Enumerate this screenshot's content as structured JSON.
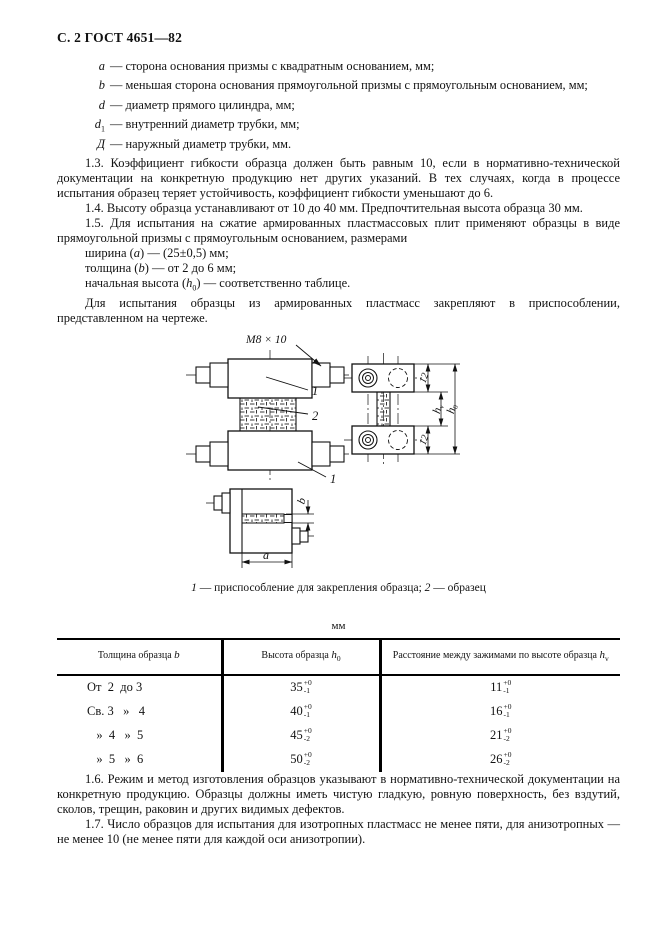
{
  "header": "С. 2 ГОСТ 4651—82",
  "definitions": [
    {
      "term": "a",
      "sub": "",
      "text": "— сторона основания призмы с квадратным основанием, мм;"
    },
    {
      "term": "b",
      "sub": "",
      "text": "— меньшая сторона основания прямоугольной призмы с прямоугольным основанием, мм;"
    },
    {
      "term": "d",
      "sub": "",
      "text": "— диаметр прямого цилиндра, мм;"
    },
    {
      "term": "d",
      "sub": "1",
      "text": "— внутренний диаметр трубки, мм;"
    },
    {
      "term": "Д",
      "sub": "",
      "text": "— наружный диаметр трубки, мм."
    }
  ],
  "para_1_3": "1.3. Коэффициент гибкости образца должен быть равным 10, если в нормативно-технической документации на конкретную продукцию нет других указаний. В тех случаях, когда в процессе испытания образец теряет устойчивость, коэффициент гибкости уменьшают до 6.",
  "para_1_4": "1.4. Высоту образца устанавливают от 10 до 40 мм. Предпочтительная высота образца 30 мм.",
  "para_1_5": "1.5. Для испытания на сжатие армированных пластмассовых плит применяют образцы в виде прямоугольной призмы с прямоугольным основанием, размерами",
  "spec_width": {
    "pre": "ширина (",
    "var": "a",
    "post": ") — (25±0,5) мм;"
  },
  "spec_thickness": {
    "pre": "толщина (",
    "var": "b",
    "post": ") — от 2 до 6 мм;"
  },
  "spec_height": {
    "pre": "начальная высота (",
    "var": "h",
    "sub": "0",
    "post": ") — соответственно таблице."
  },
  "para_fixture": "Для испытания образцы из армированных пластмасс закрепляют в приспособлении, представленном на чертеже.",
  "figure": {
    "thread_label": "М8 × 10",
    "callout_fixture_top": "1",
    "callout_specimen": "2",
    "callout_fixture_bottom": "1",
    "dim_top": "12",
    "dim_bottom": "12",
    "dim_hv": {
      "var": "h",
      "sub": "v"
    },
    "dim_h0": {
      "var": "h",
      "sub": "0"
    },
    "dim_b": "b",
    "dim_a": "a",
    "caption": [
      {
        "num": "1",
        "text": " — приспособление для закрепления образца; "
      },
      {
        "num": "2",
        "text": " — образец"
      }
    ]
  },
  "table": {
    "units": "мм",
    "headers": [
      {
        "pre": "Толщина образца ",
        "var": "b",
        "sub": ""
      },
      {
        "pre": "Высота образца ",
        "var": "h",
        "sub": "0"
      },
      {
        "pre": "Расстояние между зажимами по высоте образца ",
        "var": "h",
        "sub": "v"
      }
    ],
    "rows": [
      {
        "b": "От  2  до 3",
        "h0": {
          "v": "35",
          "sup": "+0",
          "sub": "-1"
        },
        "hv": {
          "v": "11",
          "sup": "+0",
          "sub": "-1"
        }
      },
      {
        "b": "Св. 3   »   4",
        "h0": {
          "v": "40",
          "sup": "+0",
          "sub": "-1"
        },
        "hv": {
          "v": "16",
          "sup": "+0",
          "sub": "-1"
        }
      },
      {
        "b": "   »  4   »  5",
        "h0": {
          "v": "45",
          "sup": "+0",
          "sub": "-2"
        },
        "hv": {
          "v": "21",
          "sup": "+0",
          "sub": "-2"
        }
      },
      {
        "b": "   »  5   »  6",
        "h0": {
          "v": "50",
          "sup": "+0",
          "sub": "-2"
        },
        "hv": {
          "v": "26",
          "sup": "+0",
          "sub": "-2"
        }
      }
    ]
  },
  "para_1_6": "1.6. Режим и метод изготовления образцов указывают в нормативно-технической документации на конкретную продукцию. Образцы должны иметь чистую гладкую, ровную поверхность, без вздутий, сколов, трещин, раковин и других видимых дефектов.",
  "para_1_7": "1.7. Число образцов для испытания для изотропных пластмасс не менее пяти, для анизотропных — не менее 10 (не менее пяти для каждой оси анизотропии)."
}
